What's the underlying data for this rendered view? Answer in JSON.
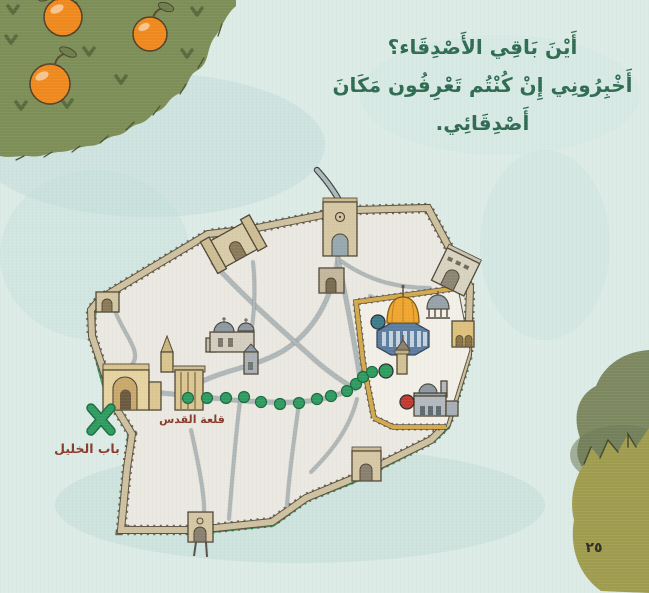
{
  "page": {
    "background_color": "#dcebe6",
    "page_number": "٢٥"
  },
  "narration": {
    "color": "#2e6b51",
    "lines": [
      "أَيْنَ بَاقِي الأَصْدِقَاء؟",
      "أَخْبِرُونِي إِنْ كُنْتُم تَعْرِفُون مَكَانَ",
      "أَصْدِقَائِي."
    ]
  },
  "map": {
    "citadel_label": "قلعة القدس",
    "gate_label": "باب الخليل",
    "label_color": "#8a3a2a",
    "wall_color": "#cec19f",
    "street_color": "#aeb7b9",
    "haram_edge_color": "#d4a94c",
    "path_color": "#2f9c60",
    "path_dots": [
      [
        188,
        398
      ],
      [
        207,
        398
      ],
      [
        226,
        398
      ],
      [
        244,
        397
      ],
      [
        261,
        402
      ],
      [
        280,
        404
      ],
      [
        299,
        403
      ],
      [
        317,
        399
      ],
      [
        331,
        396
      ],
      [
        347,
        391
      ],
      [
        356,
        384
      ],
      [
        363,
        377
      ],
      [
        372,
        372
      ],
      [
        387,
        370
      ]
    ],
    "markers": [
      {
        "name": "teal-location-marker",
        "color": "#3c7c8c",
        "x": 378,
        "y": 322,
        "r": 7
      },
      {
        "name": "green-location-marker",
        "color": "#2f9c60",
        "x": 386,
        "y": 371,
        "r": 7
      },
      {
        "name": "red-location-marker",
        "color": "#c23a2f",
        "x": 407,
        "y": 402,
        "r": 7
      }
    ],
    "x_mark_color": "#2f9c60"
  },
  "scenery": {
    "tree_color": "#7d8e57",
    "orange_color": "#f0891d",
    "bush_back_color": "#7d8861",
    "bush_front_color": "#a09c4e"
  }
}
